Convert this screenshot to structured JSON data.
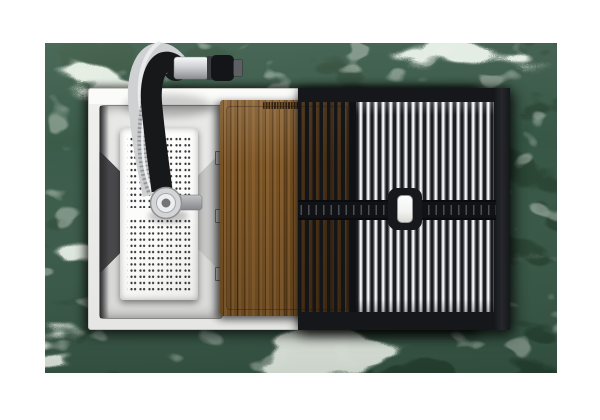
{
  "meta": {
    "type": "product-photograph",
    "view": "top-down",
    "subject": "Stainless steel workstation kitchen sink set into a green marble countertop, with matte-black pull-down faucet, perforated colander basket, walnut cutting board and roll-up stainless drying rack"
  },
  "canvas": {
    "width": 600,
    "height": 420,
    "background": "#ffffff"
  },
  "colors": {
    "canvas_bg": "#ffffff",
    "marble_base": "#2c4736",
    "marble_light": "#3d5c47",
    "marble_dark": "#13251a",
    "marble_vein": "#d8e6d2",
    "sink_rim": "#f1f1ef",
    "sink_rim_edge": "#c6c6c3",
    "bowl_left": "#4a4a4c",
    "bowl_top": "#e8e8e7",
    "bowl_right": "#c7c7c6",
    "bowl_bottom": "#dadad8",
    "colander_body": "#fbfbfa",
    "colander_hole": "#3a3a3c",
    "faucet_black": "#17181a",
    "faucet_chrome": "#cfd1d3",
    "wood_light": "#8a6130",
    "wood_mid": "#7a5426",
    "wood_dark": "#5c3c17",
    "rack_frame": "#16171a",
    "rack_rod_light": "#f4f5f6",
    "rack_rod_shade": "#7b7d82",
    "rack_gap": "#1b1c1f",
    "rack_handle": "#f2f2ef"
  },
  "objects": {
    "countertop": {
      "label": "green marble countertop"
    },
    "sink": {
      "label": "stainless steel sink with white rim"
    },
    "colander": {
      "label": "white perforated colander basket"
    },
    "faucet": {
      "label": "black gooseneck faucet with chrome spray head and braided hose"
    },
    "cutting_board": {
      "label": "walnut cutting board with juice groove",
      "stamp": "small engraved brand stamp (illegible)"
    },
    "drying_rack": {
      "label": "roll-up drying rack, black frame with polished rods and white lift handle"
    }
  }
}
